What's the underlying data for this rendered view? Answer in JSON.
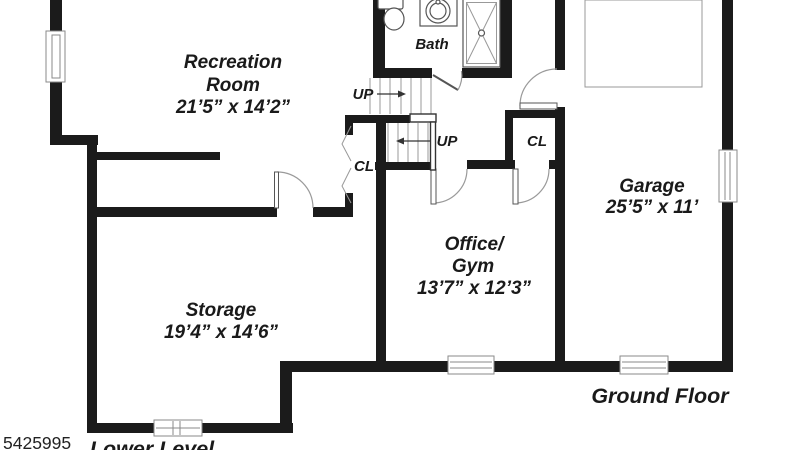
{
  "watermark": {
    "listing_number": "5425995"
  },
  "floor_labels": {
    "lower": "Lower Level",
    "ground": "Ground Floor"
  },
  "rooms": {
    "recreation": {
      "line1": "Recreation",
      "line2": "Room",
      "dims": "21’5” x 14’2”"
    },
    "storage": {
      "name": "Storage",
      "dims": "19’4” x 14’6”"
    },
    "office_gym": {
      "line1": "Office/",
      "line2": "Gym",
      "dims": "13’7” x 12’3”"
    },
    "garage": {
      "name": "Garage",
      "dims": "25’5” x 11’"
    },
    "bath": {
      "name": "Bath"
    }
  },
  "annotations": {
    "up1": "UP",
    "up2": "UP",
    "cl1": "CL",
    "cl2": "CL"
  },
  "fixtures": [
    "toilet-icon",
    "sink-icon",
    "shower-icon"
  ],
  "colors": {
    "wall": "#1b1b1b",
    "thin_line": "#999999",
    "text": "#1a1a1a",
    "background": "#ffffff"
  }
}
